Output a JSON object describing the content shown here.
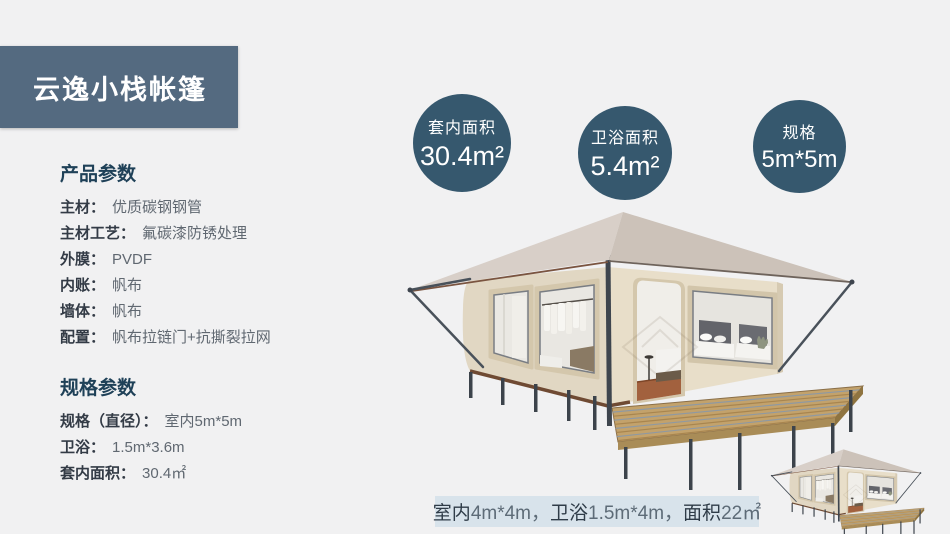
{
  "header": {
    "title": "云逸小栈帐篷"
  },
  "product_params": {
    "heading": "产品参数",
    "items": [
      {
        "label": "主材：",
        "value": "优质碳钢钢管"
      },
      {
        "label": "主材工艺：",
        "value": "氟碳漆防锈处理"
      },
      {
        "label": "外膜：",
        "value": "PVDF"
      },
      {
        "label": "内账：",
        "value": "帆布"
      },
      {
        "label": "墙体：",
        "value": "帆布"
      },
      {
        "label": "配置：",
        "value": "帆布拉链门+抗撕裂拉网"
      }
    ]
  },
  "spec_params": {
    "heading": "规格参数",
    "items": [
      {
        "label": "规格（直径）：",
        "value": "室内5m*5m"
      },
      {
        "label": "卫浴：",
        "value": "1.5m*3.6m"
      },
      {
        "label": "套内面积：",
        "value": "30.4㎡"
      }
    ]
  },
  "badges": [
    {
      "label": "套内面积",
      "value": "30.4m²"
    },
    {
      "label": "卫浴面积",
      "value": "5.4m²"
    },
    {
      "label": "规格",
      "value": "5m*5m"
    }
  ],
  "caption": {
    "segments": [
      {
        "label": "室内",
        "value": "4m*4m，"
      },
      {
        "label": "卫浴",
        "value": "1.5m*4m，"
      },
      {
        "label": "面积",
        "value": "22㎡"
      }
    ]
  },
  "colors": {
    "background": "#f1f1f2",
    "title_box": "#546a80",
    "badge_circle": "#36586e",
    "heading_text": "#1f4158",
    "caption_bg": "#d8e3eb",
    "tent_wall": "#e3d9c5",
    "tent_roof": "#d3cac2",
    "deck_wood": "#c3a26b",
    "metal_frame": "#3e454e"
  }
}
